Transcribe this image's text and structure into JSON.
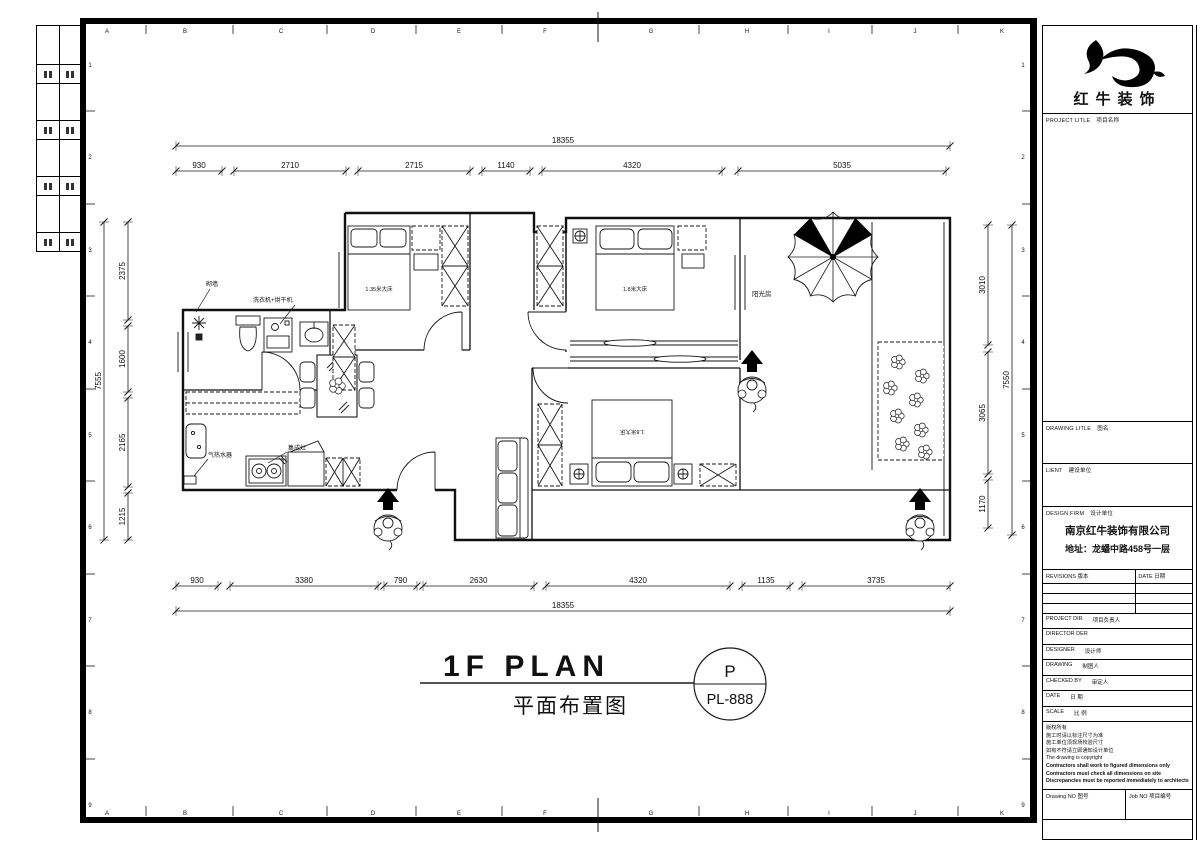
{
  "sheet": {
    "grid_letters": [
      "A",
      "B",
      "C",
      "D",
      "E",
      "F",
      "G",
      "H",
      "I",
      "J",
      "K"
    ],
    "grid_numbers": [
      "1",
      "2",
      "3",
      "4",
      "5",
      "6",
      "7",
      "8",
      "9"
    ]
  },
  "drawing_title": {
    "en": "1F PLAN",
    "cn": "平面布置图",
    "bubble_top": "P",
    "bubble_bottom": "PL-888"
  },
  "dimensions": {
    "top": {
      "total": "18355",
      "segments": [
        "930",
        "2710",
        "2715",
        "1140",
        "4320",
        "5035"
      ]
    },
    "bottom": {
      "total": "18355",
      "segments": [
        "930",
        "3380",
        "790",
        "2630",
        "4320",
        "1135",
        "3735"
      ]
    },
    "left": {
      "total": "7555",
      "segments": [
        "2375",
        "1600",
        "2165",
        "1215"
      ]
    },
    "right": {
      "total": "7550",
      "segments": [
        "3010",
        "3065",
        "1170"
      ]
    }
  },
  "plan_labels": {
    "new_wall": "砌墙",
    "washer_dryer": "洗衣机+烘干机",
    "bed_left": "1.35米大床",
    "bed_middle": "1.8米大床",
    "bed_bottom": "1.8米大床",
    "sunroom": "阳光房",
    "water_heater": "气热水器",
    "integrated_stove": "集成灶"
  },
  "title_block": {
    "logo_text": "红牛装饰",
    "project_label_en": "PROJECT LITLE",
    "project_label_cn": "项目名称",
    "drawing_label_en": "DRAWING LITLE",
    "drawing_label_cn": "图名",
    "client_label_en": "LIENT",
    "client_label_cn": "建设单位",
    "firm_label_en": "DESIGN FIRM",
    "firm_label_cn": "设计单位",
    "firm_name": "南京红牛装饰有限公司",
    "firm_address": "地址：龙蟠中路458号一层",
    "revisions_label_en": "REVISIONS",
    "revisions_label_cn": "版本",
    "date_col_en": "DATE",
    "date_col_cn": "日期",
    "rows": [
      {
        "en": "PROJECT DIR",
        "cn": "项目负责人"
      },
      {
        "en": "DIRECTOR DER",
        "cn": ""
      },
      {
        "en": "DESIGNER",
        "cn": "设计师"
      },
      {
        "en": "DRAWING",
        "cn": "制图人"
      },
      {
        "en": "CHECKED BY",
        "cn": "审定人"
      },
      {
        "en": "DATE",
        "cn": "日 期"
      },
      {
        "en": "SCALE",
        "cn": "比 例"
      }
    ],
    "notes": [
      "版权所有",
      "施工时请以标注尺寸为准",
      "施工单位须现场校验尺寸",
      "如有不符请立即通知设计单位",
      "The drawing is copyright",
      "Contractors shall work to figured dimensions only",
      "Contractors must check all dimensions on site",
      "Discrepancies must be reported immediately to architects"
    ],
    "footer": {
      "drawing_no_en": "Drawing NO",
      "drawing_no_cn": "图号",
      "job_no_en": "Job NO",
      "job_no_cn": "项目编号"
    }
  }
}
